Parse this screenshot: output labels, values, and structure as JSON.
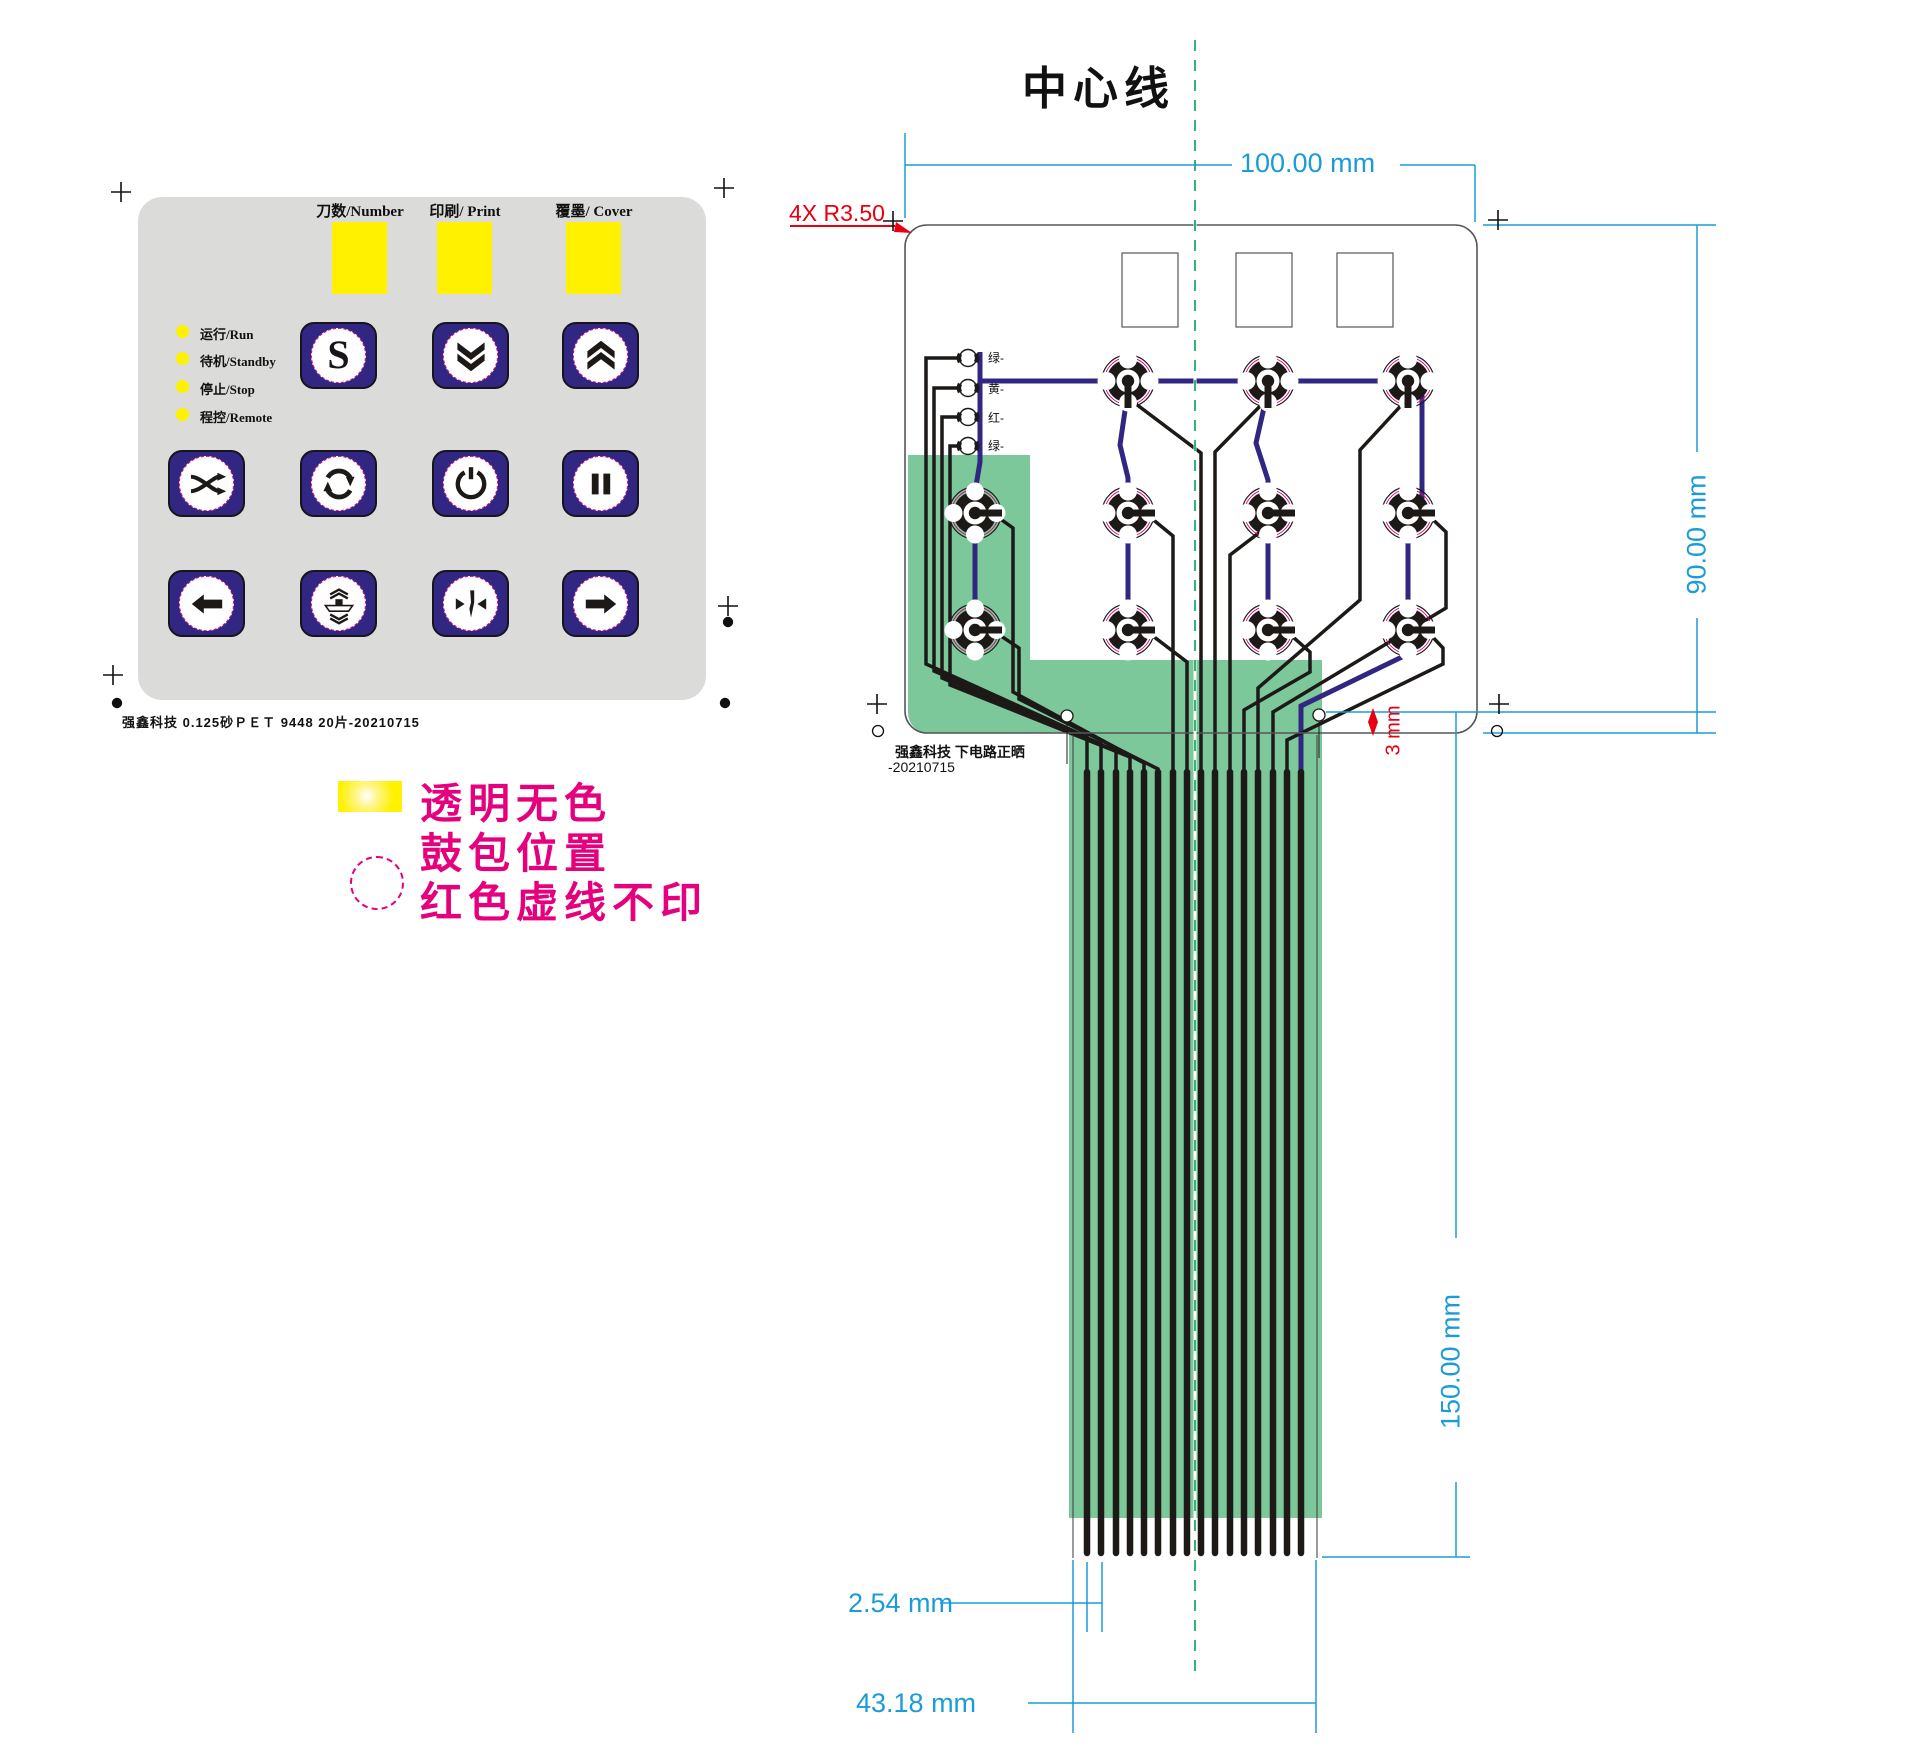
{
  "keypad": {
    "windows": [
      {
        "label": "刀数/Number"
      },
      {
        "label": "印刷/ Print"
      },
      {
        "label": "覆墨/ Cover"
      }
    ],
    "leds": [
      {
        "label": "运行/Run"
      },
      {
        "label": "待机/Standby"
      },
      {
        "label": "停止/Stop"
      },
      {
        "label": "程控/Remote"
      }
    ],
    "s_label": "S",
    "icons": [
      "s-button",
      "chevron-double-down",
      "chevron-double-up",
      "shuffle",
      "cycle",
      "power",
      "pause",
      "arrow-left",
      "press",
      "cut",
      "arrow-right"
    ],
    "footer": "强鑫科技  0.125砂ＰＥＴ  9448  20片-20210715"
  },
  "legend": {
    "line1": "透明无色",
    "line2": "鼓包位置",
    "line3": "红色虚线不印"
  },
  "diagram": {
    "title": "中心线",
    "corner_note": "4X R3.50",
    "dim_width": "100.00 mm",
    "dim_height": "90.00 mm",
    "dim_tail_length": "150.00 mm",
    "dim_pitch": "2.54 mm",
    "dim_tail_width": "43.18 mm",
    "dim_hole": "3 mm",
    "led_labels": [
      {
        "label": "绿-"
      },
      {
        "label": "黄-"
      },
      {
        "label": "红-"
      },
      {
        "label": "绿-"
      }
    ],
    "footer_line1": "强鑫科技  下电路正晒",
    "footer_line2": "-20210715"
  },
  "colors": {
    "keypad_gray": "#dbdbd9",
    "button_navy": "#312783",
    "window_yellow": "#fff100",
    "legend_magenta": "#e5007e",
    "dimension_blue": "#1b9cd8",
    "note_red": "#e60012",
    "tail_green": "#7cc89b",
    "centerline_green": "#35b378",
    "trace_black": "#1c1917",
    "trace_navy": "#312783"
  }
}
